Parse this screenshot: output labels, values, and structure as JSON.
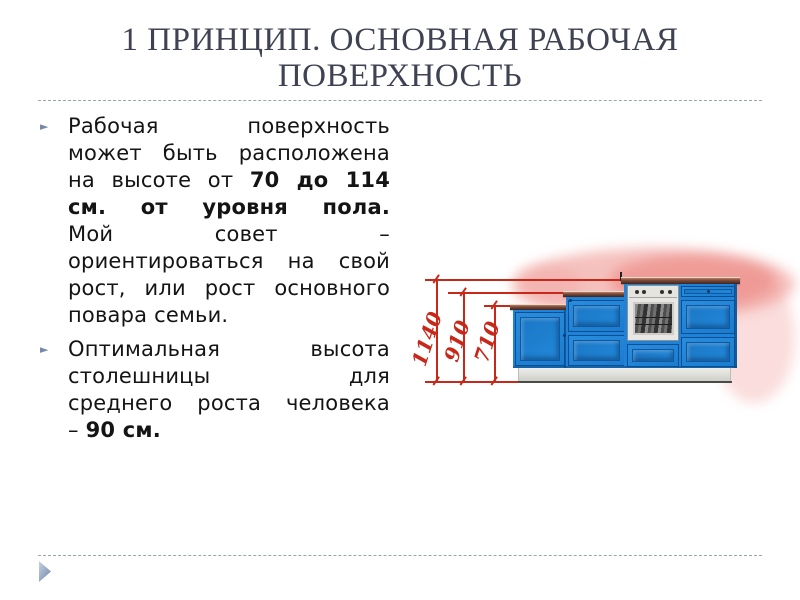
{
  "slide": {
    "title": "1 ПРИНЦИП. ОСНОВНАЯ РАБОЧАЯ ПОВЕРХНОСТЬ",
    "bullet_marker": "►",
    "bullets": [
      {
        "lines": [
          [
            {
              "t": "Рабочая поверхность"
            }
          ],
          [
            {
              "t": "может быть расположена"
            }
          ],
          [
            {
              "t": "на высоте от "
            },
            {
              "t": "70 до 114",
              "b": true
            }
          ],
          [
            {
              "t": "см. от уровня пола.",
              "b": true
            }
          ],
          [
            {
              "t": "Мой совет –"
            }
          ],
          [
            {
              "t": "ориентироваться на свой"
            }
          ],
          [
            {
              "t": "рост, или рост основного"
            }
          ],
          [
            {
              "t": "повара семьи."
            }
          ]
        ]
      },
      {
        "lines": [
          [
            {
              "t": "Оптимальная высота"
            }
          ],
          [
            {
              "t": "столешницы для"
            }
          ],
          [
            {
              "t": "среднего роста человека"
            }
          ],
          [
            {
              "t": "– "
            },
            {
              "t": "90 см.",
              "b": true
            }
          ]
        ]
      }
    ]
  },
  "figure": {
    "dimension_labels": [
      "1140",
      "910",
      "710"
    ]
  },
  "colors": {
    "title": "#3f4252",
    "body_text": "#141414",
    "bullet_marker": "#7787a8",
    "divider": "#9aa3ae",
    "dimension_red": "#c8281a",
    "cabinet_blue": "#1e83d8",
    "cabinet_blue_dark": "#0b4f92",
    "countertop_brown": "#5a362e",
    "nav_arrow": "#8ba0bd"
  }
}
